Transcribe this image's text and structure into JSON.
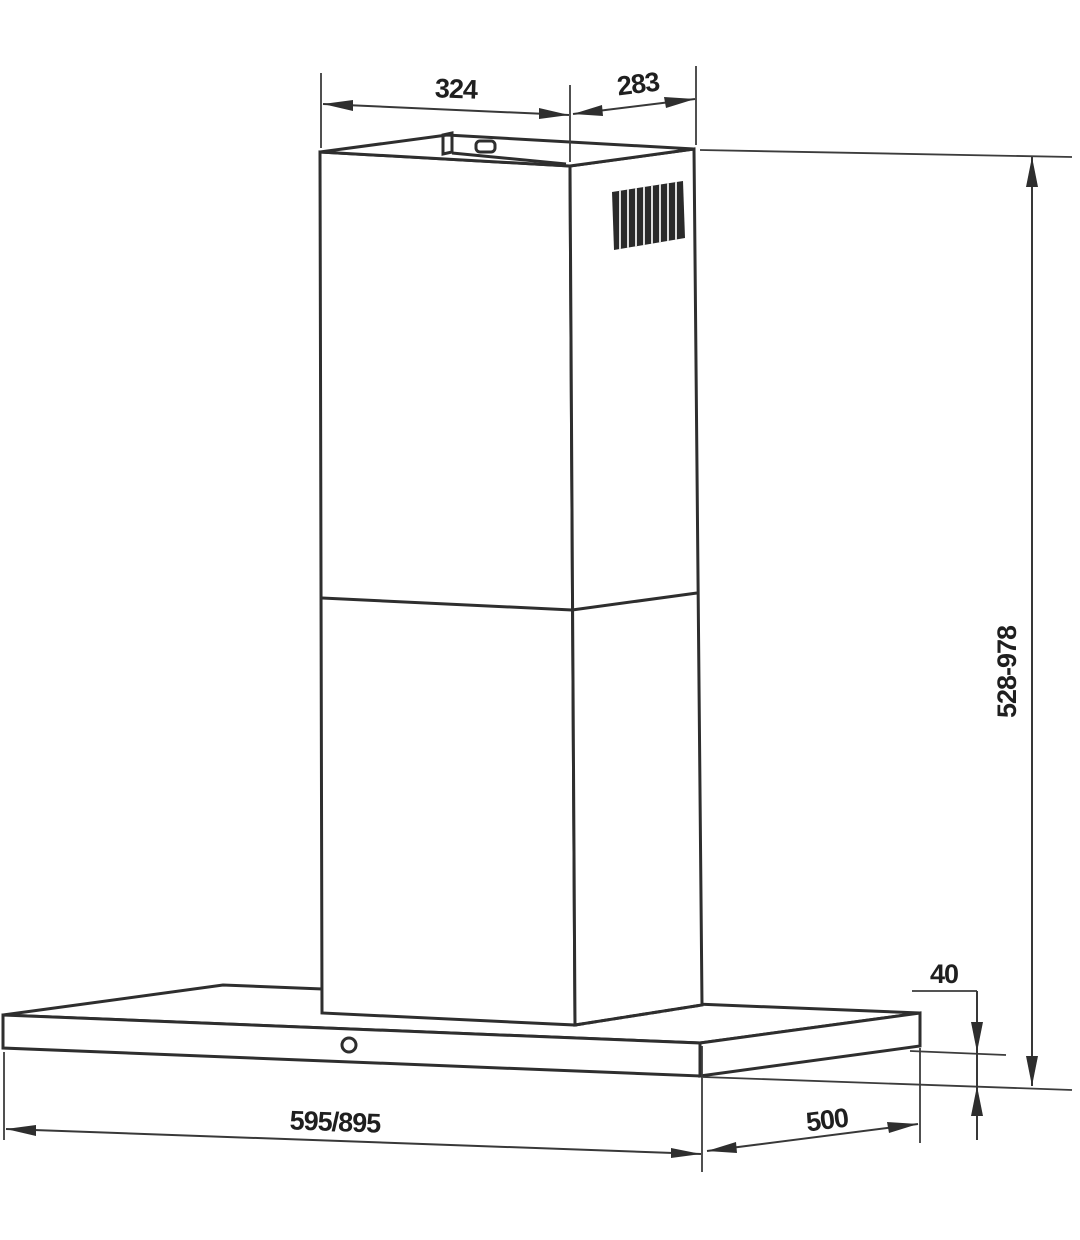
{
  "drawing": {
    "kind": "chimney-range-hood-dimension-diagram",
    "background_color": "#ffffff",
    "line_color": "#2e2e2e",
    "dimension_line_color": "#383838",
    "text_color": "#1f1f1f",
    "labels": {
      "chimney_top_width": "324",
      "chimney_top_depth": "283",
      "mounting_height_range": "528-978",
      "body_panel_height": "40",
      "body_width_options": "595/895",
      "body_depth": "500"
    }
  }
}
